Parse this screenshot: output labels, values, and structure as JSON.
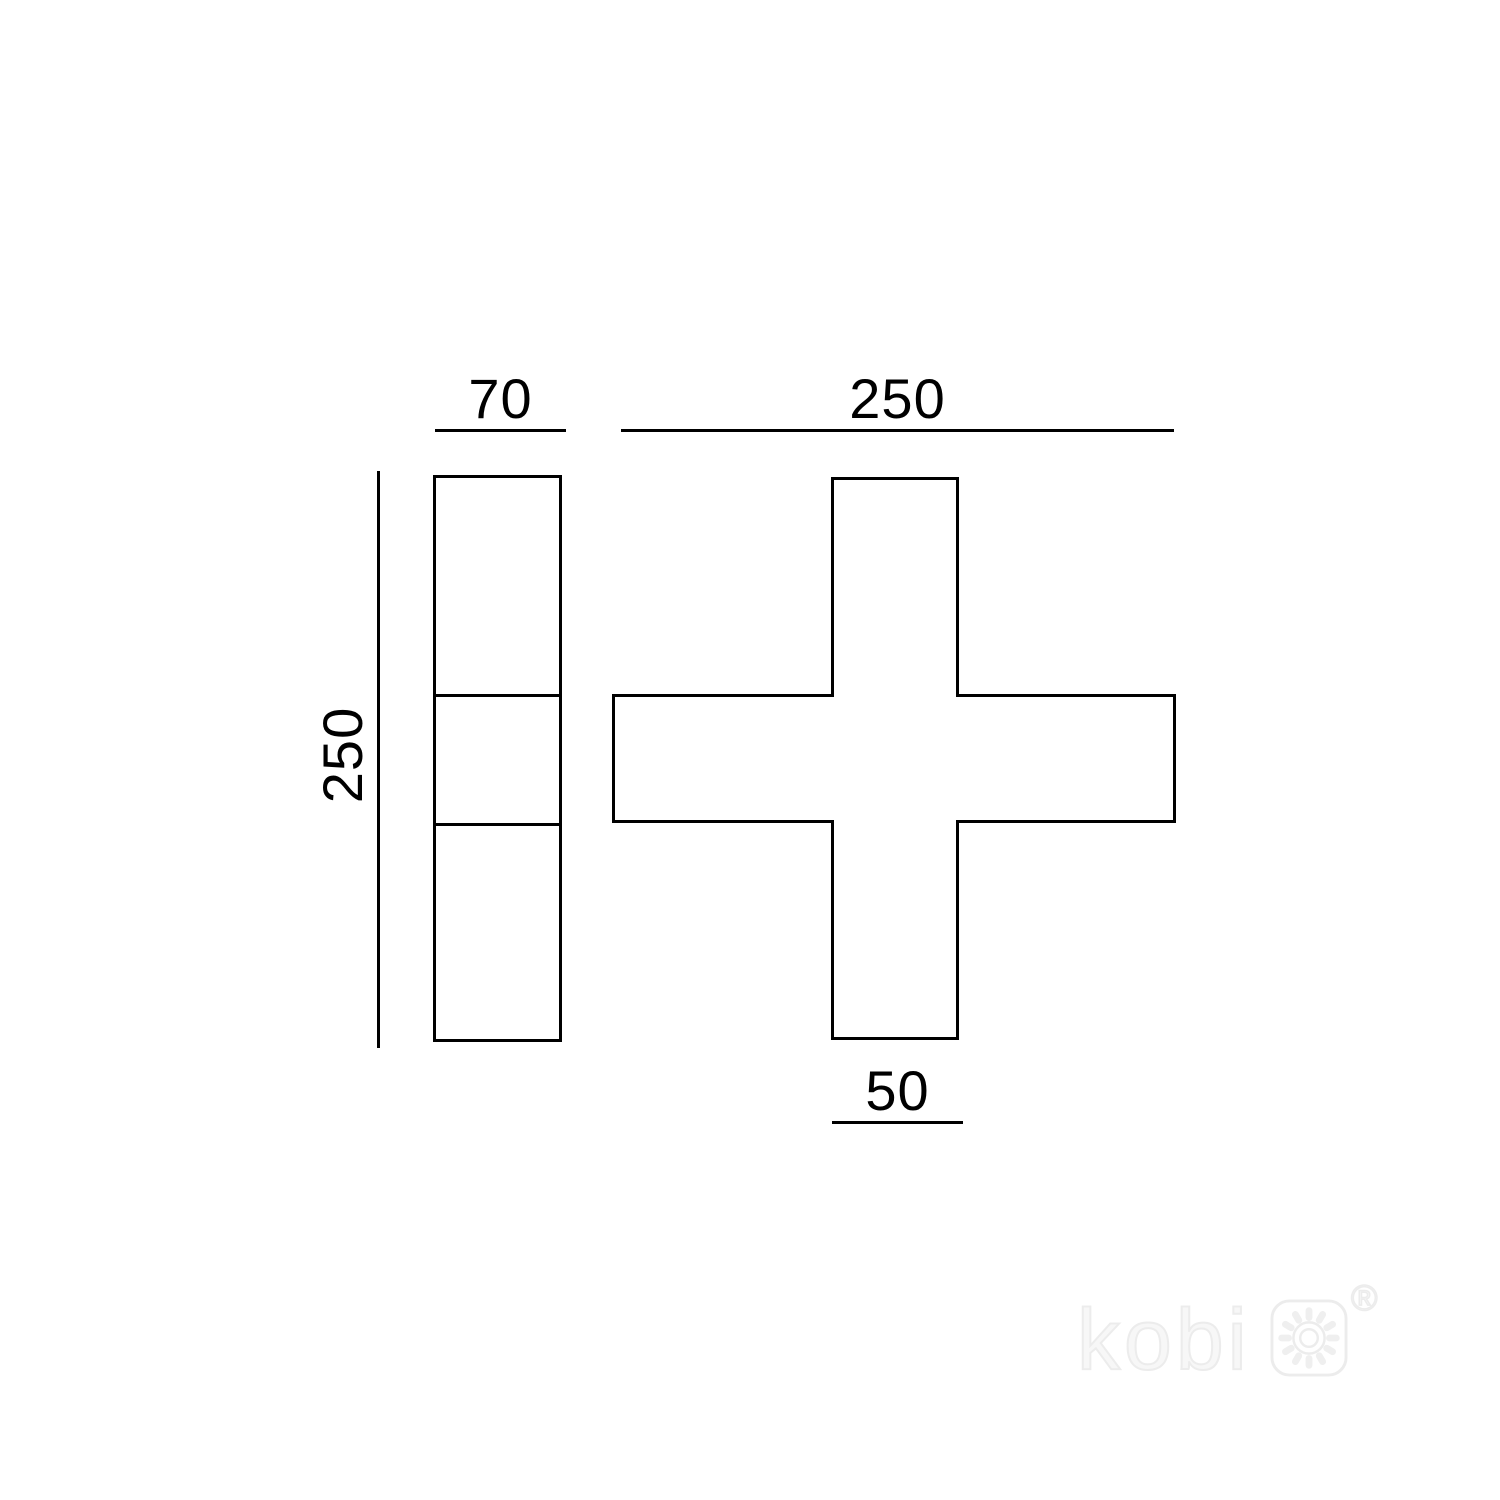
{
  "page": {
    "type": "technical-dimension-drawing",
    "background_color": "#ffffff",
    "line_color": "#000000"
  },
  "drawing": {
    "labels": {
      "side_width": "70",
      "overall_width": "250",
      "overall_height": "250",
      "arm_width": "50"
    }
  },
  "watermark": {
    "brand": "kobi",
    "registered_mark": "®",
    "icon": "sun-in-rounded-square-icon",
    "color": "#ececec"
  }
}
